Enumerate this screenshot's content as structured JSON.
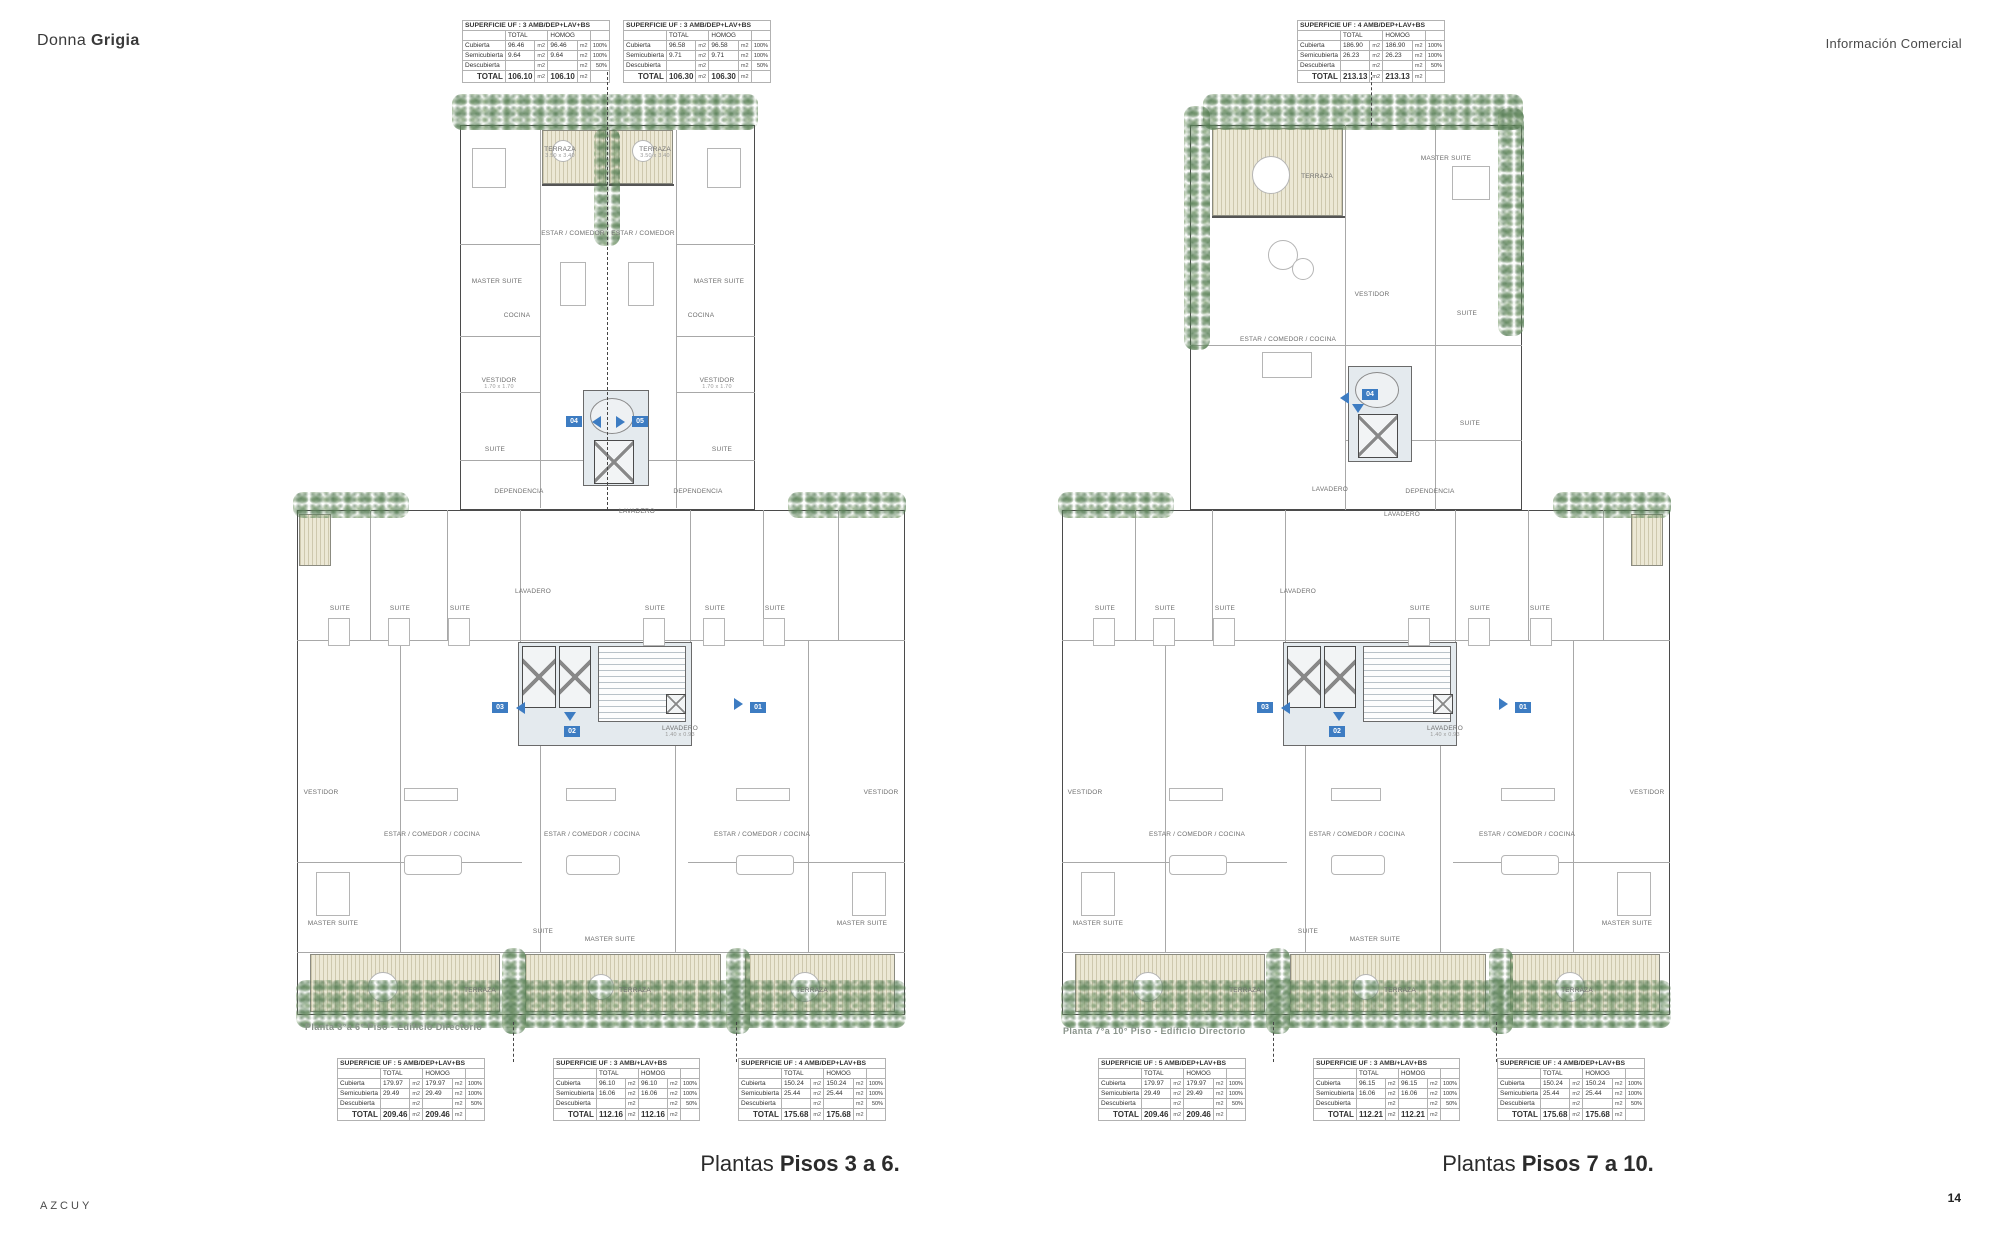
{
  "header": {
    "brand_regular": "Donna",
    "brand_bold": "Grigia",
    "top_right": "Información Comercial"
  },
  "footer": {
    "brand": "AZCUY",
    "page_number": "14"
  },
  "captions": {
    "left": {
      "regular": "Plantas",
      "bold": "Pisos 3 a 6."
    },
    "right": {
      "regular": "Plantas",
      "bold": "Pisos 7 a 10."
    }
  },
  "plans": {
    "left": {
      "sheet_label": "Planta 3°a 6° Piso - Edificio Directorio",
      "markers": {
        "m01": "01",
        "m02": "02",
        "m03": "03",
        "m04": "04",
        "m05": "05"
      }
    },
    "right": {
      "sheet_label": "Planta 7°a 10° Piso - Edificio Directorio",
      "markers": {
        "m01": "01",
        "m02": "02",
        "m03": "03",
        "m04": "04"
      }
    }
  },
  "room_names": {
    "terraza": "TERRAZA",
    "master_suite": "MASTER SUITE",
    "vestidor": "VESTIDOR",
    "estar_comedor": "ESTAR / COMEDOR",
    "cocina": "COCINA",
    "suite": "SUITE",
    "dependencia": "DEPENDENCIA",
    "lavadero": "LAVADERO",
    "estar_comedor_cocina": "ESTAR / COMEDOR / COCINA"
  },
  "room_dims": {
    "terraza_small": "3.50 x 3.40",
    "vestidor_small": "1.70 x 1.70",
    "lavadero_small": "1.40 x 0.93"
  },
  "tables": {
    "unit": "m2",
    "col_total": "TOTAL",
    "col_homog": "HOMOG",
    "total_label": "TOTAL",
    "tl1": {
      "title": "SUPERFICIE UF  : 3 AMB/DEP+LAV+BS",
      "rows": [
        {
          "label": "Cubierta",
          "total": "96.46",
          "homog": "96.46",
          "pct": "100%"
        },
        {
          "label": "Semicubierta",
          "total": "9.64",
          "homog": "9.64",
          "pct": "100%"
        },
        {
          "label": "Descubierta",
          "total": "",
          "homog": "",
          "pct": "50%"
        }
      ],
      "total_total": "106.10",
      "total_homog": "106.10"
    },
    "tl2": {
      "title": "SUPERFICIE UF  : 3 AMB/DEP+LAV+BS",
      "rows": [
        {
          "label": "Cubierta",
          "total": "96.58",
          "homog": "96.58",
          "pct": "100%"
        },
        {
          "label": "Semicubierta",
          "total": "9.71",
          "homog": "9.71",
          "pct": "100%"
        },
        {
          "label": "Descubierta",
          "total": "",
          "homog": "",
          "pct": "50%"
        }
      ],
      "total_total": "106.30",
      "total_homog": "106.30"
    },
    "tr1": {
      "title": "SUPERFICIE UF  : 4 AMB/DEP+LAV+BS",
      "rows": [
        {
          "label": "Cubierta",
          "total": "186.90",
          "homog": "186.90",
          "pct": "100%"
        },
        {
          "label": "Semicubierta",
          "total": "26.23",
          "homog": "26.23",
          "pct": "100%"
        },
        {
          "label": "Descubierta",
          "total": "",
          "homog": "",
          "pct": "50%"
        }
      ],
      "total_total": "213.13",
      "total_homog": "213.13"
    },
    "bl1": {
      "title": "SUPERFICIE UF  : 5 AMB/DEP+LAV+BS",
      "rows": [
        {
          "label": "Cubierta",
          "total": "179.97",
          "homog": "179.97",
          "pct": "100%"
        },
        {
          "label": "Semicubierta",
          "total": "29.49",
          "homog": "29.49",
          "pct": "100%"
        },
        {
          "label": "Descubierta",
          "total": "",
          "homog": "",
          "pct": "50%"
        }
      ],
      "total_total": "209.46",
      "total_homog": "209.46"
    },
    "bl2": {
      "title": "SUPERFICIE UF  : 3 AMB/+LAV+BS",
      "rows": [
        {
          "label": "Cubierta",
          "total": "96.10",
          "homog": "96.10",
          "pct": "100%"
        },
        {
          "label": "Semicubierta",
          "total": "16.06",
          "homog": "16.06",
          "pct": "100%"
        },
        {
          "label": "Descubierta",
          "total": "",
          "homog": "",
          "pct": "50%"
        }
      ],
      "total_total": "112.16",
      "total_homog": "112.16"
    },
    "bl3": {
      "title": "SUPERFICIE UF  : 4 AMB/DEP+LAV+BS",
      "rows": [
        {
          "label": "Cubierta",
          "total": "150.24",
          "homog": "150.24",
          "pct": "100%"
        },
        {
          "label": "Semicubierta",
          "total": "25.44",
          "homog": "25.44",
          "pct": "100%"
        },
        {
          "label": "Descubierta",
          "total": "",
          "homog": "",
          "pct": "50%"
        }
      ],
      "total_total": "175.68",
      "total_homog": "175.68"
    },
    "br1": {
      "title": "SUPERFICIE UF  : 5 AMB/DEP+LAV+BS",
      "rows": [
        {
          "label": "Cubierta",
          "total": "179.97",
          "homog": "179.97",
          "pct": "100%"
        },
        {
          "label": "Semicubierta",
          "total": "29.49",
          "homog": "29.49",
          "pct": "100%"
        },
        {
          "label": "Descubierta",
          "total": "",
          "homog": "",
          "pct": "50%"
        }
      ],
      "total_total": "209.46",
      "total_homog": "209.46"
    },
    "br2": {
      "title": "SUPERFICIE UF  : 3 AMB/+LAV+BS",
      "rows": [
        {
          "label": "Cubierta",
          "total": "96.15",
          "homog": "96.15",
          "pct": "100%"
        },
        {
          "label": "Semicubierta",
          "total": "16.06",
          "homog": "16.06",
          "pct": "100%"
        },
        {
          "label": "Descubierta",
          "total": "",
          "homog": "",
          "pct": "50%"
        }
      ],
      "total_total": "112.21",
      "total_homog": "112.21"
    },
    "br3": {
      "title": "SUPERFICIE UF  : 4 AMB/DEP+LAV+BS",
      "rows": [
        {
          "label": "Cubierta",
          "total": "150.24",
          "homog": "150.24",
          "pct": "100%"
        },
        {
          "label": "Semicubierta",
          "total": "25.44",
          "homog": "25.44",
          "pct": "100%"
        },
        {
          "label": "Descubierta",
          "total": "",
          "homog": "",
          "pct": "50%"
        }
      ],
      "total_total": "175.68",
      "total_homog": "175.68"
    }
  },
  "colors": {
    "marker_blue": "#3D7CC2",
    "plant_green": "#6A9168",
    "terrace_beige": "#ECE8D5",
    "wall_gray": "#4B4B4B"
  }
}
